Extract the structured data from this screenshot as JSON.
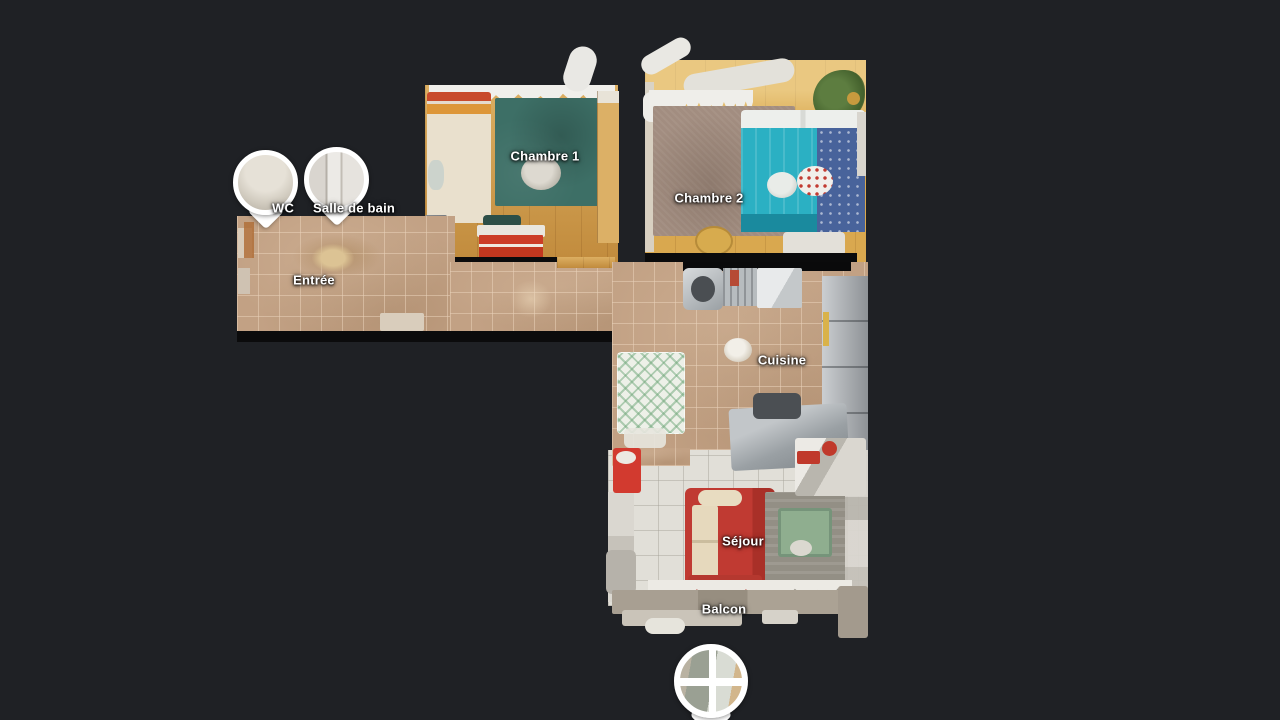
{
  "app": {
    "type": "floorplan-viewer",
    "background_color": "#1f2125"
  },
  "rooms": [
    {
      "id": "entree",
      "label": "Entrée"
    },
    {
      "id": "chambre-1",
      "label": "Chambre 1"
    },
    {
      "id": "chambre-2",
      "label": "Chambre 2"
    },
    {
      "id": "cuisine",
      "label": "Cuisine"
    },
    {
      "id": "sejour",
      "label": "Séjour"
    },
    {
      "id": "balcon",
      "label": "Balcon"
    }
  ],
  "pins": [
    {
      "id": "wc",
      "label": "WC",
      "photo": "toilet-room-thumbnail"
    },
    {
      "id": "salle-de-bain",
      "label": "Salle de bain",
      "photo": "bathroom-door-thumbnail"
    },
    {
      "id": "balcony-window",
      "label": "",
      "photo": "window-view-thumbnail"
    }
  ],
  "palette": {
    "background": "#1f2125",
    "wall": "#0b0b0c",
    "tile_floor": "#c2a184",
    "white_tile_floor": "#e1dfd8",
    "wood_floor_1": "#cd9845",
    "wood_floor_2": "#d9a84f",
    "rug_teal": "#3d6f66",
    "rug_taupe": "#a28d80",
    "bed_turquoise": "#2bb0c3",
    "bed_blue": "#48639b",
    "sofa_red": "#c03a32",
    "cushion_cream": "#e6d9bd",
    "steel_gray": "#9aa0a4",
    "pin_white": "#ffffff",
    "label_text": "#ffffff"
  }
}
